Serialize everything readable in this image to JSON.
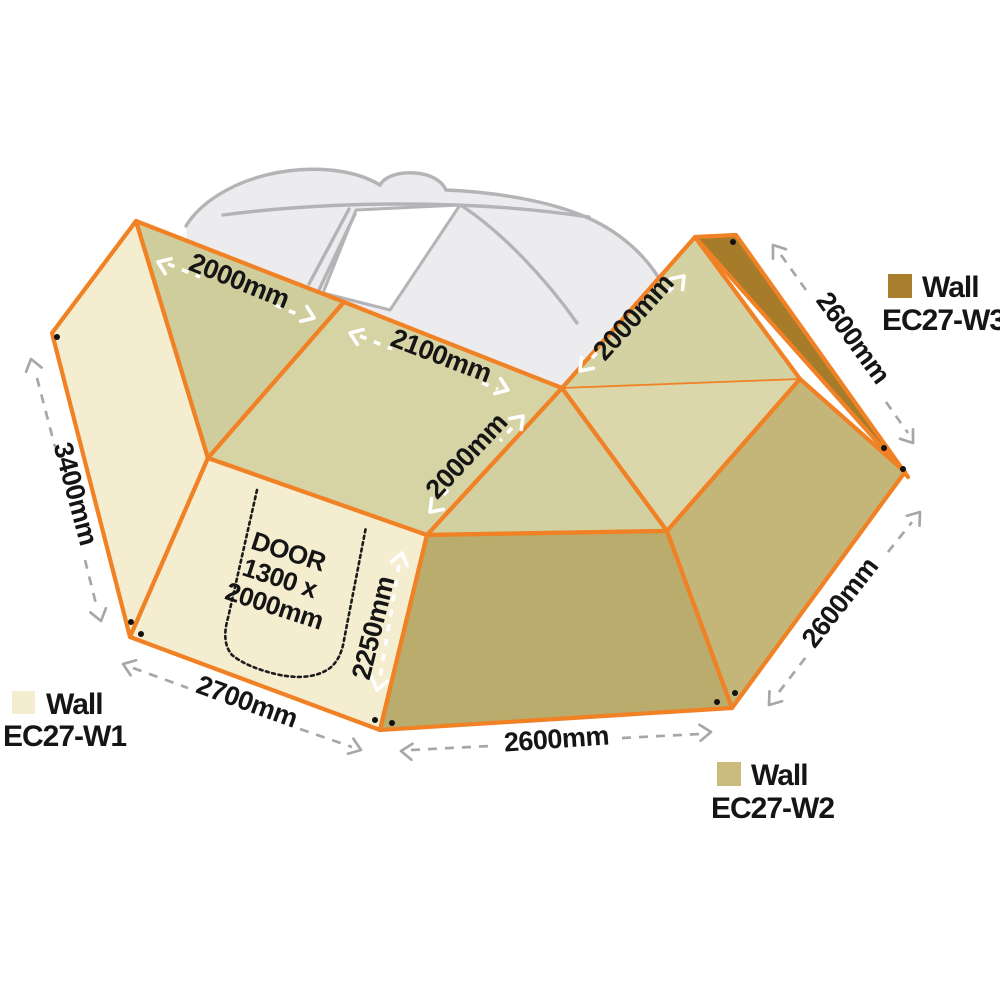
{
  "dims": {
    "roof_left": "2000mm",
    "roof_mid": "2100mm",
    "roof_inner": "2000mm",
    "roof_right": "2000mm",
    "wall1_height": "3400mm",
    "wall1_bottom": "2700mm",
    "door_edge": "2250mm",
    "wall2_bottom": "2600mm",
    "wall2_right": "2600mm",
    "wall3_edge": "2600mm"
  },
  "door": {
    "line1": "DOOR",
    "line2": "1300 x",
    "line3": "2000mm"
  },
  "legend": {
    "w1": {
      "name": "Wall",
      "code": "EC27-W1"
    },
    "w2": {
      "name": "Wall",
      "code": "EC27-W2"
    },
    "w3": {
      "name": "Wall",
      "code": "EC27-W3"
    }
  },
  "colors": {
    "orange": "#f08125",
    "cream": "#f5edd0",
    "khaki1": "#d0cd9c",
    "khaki2": "#d6d3a5",
    "khaki3": "#d2cfa0",
    "khaki4": "#dbd7ab",
    "khaki5": "#d4d1a2",
    "tan1": "#b9ac6d",
    "tan2": "#c3b678",
    "brown": "#a67c2b",
    "swatch_w1": "#f5edd0",
    "swatch_w2": "#cbbc7e",
    "swatch_w3": "#a87d2c",
    "carfill": "#ececee",
    "carline": "#b4b4b7",
    "dim": "#a7a7aa"
  }
}
